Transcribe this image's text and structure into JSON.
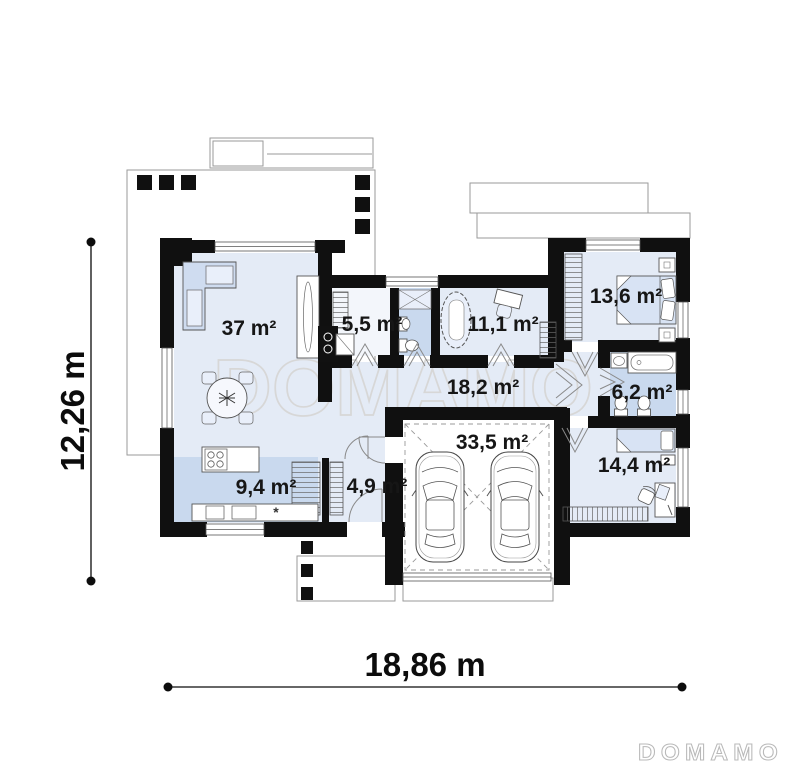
{
  "watermark": {
    "text": "DOMAMO"
  },
  "brand_logo": {
    "text": "DOMAMO"
  },
  "dimensions": {
    "height_label": "12,26 m",
    "width_label": "18,86 m"
  },
  "rooms": {
    "living": "37 m²",
    "pantry": "5,5 m²",
    "office": "11,1 m²",
    "bedroom1": "13,6 m²",
    "hallway": "18,2 m²",
    "bathroom": "6,2 m²",
    "kitchen": "9,4 m²",
    "hall": "4,9 m²",
    "garage": "33,5 m²",
    "bedroom2": "14,4 m²"
  },
  "symbols": {
    "sink_marker": "*"
  },
  "colors": {
    "wall": "#101010",
    "floor_light": "#e4ebf6",
    "floor_dark": "#c9d9ee",
    "watermark": "#d7d7d7"
  }
}
